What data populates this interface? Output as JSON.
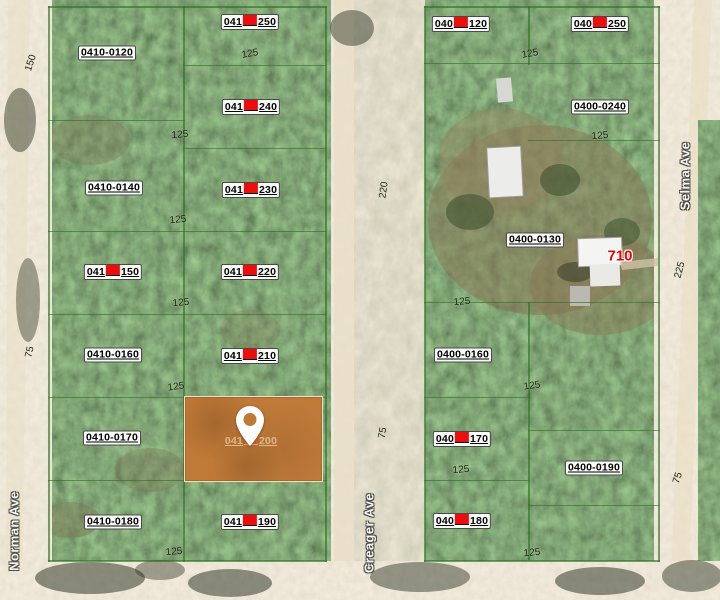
{
  "map": {
    "streets": [
      {
        "name": "Norman Ave",
        "x": 14,
        "y": 531
      },
      {
        "name": "Creager Ave",
        "x": 369,
        "y": 533
      },
      {
        "name": "Selma Ave",
        "x": 685,
        "y": 176
      }
    ],
    "house_number": {
      "text": "710",
      "x": 620,
      "y": 256
    },
    "highlighted_parcel": {
      "x": 184,
      "y": 396,
      "w": 137,
      "h": 84,
      "fill": "#bf7a38"
    },
    "parcel_labels": [
      {
        "text": "0410-0120",
        "x": 107,
        "y": 53
      },
      {
        "prefix": "041",
        "suffix": "250",
        "redacted": true,
        "x": 250,
        "y": 22
      },
      {
        "prefix": "041",
        "suffix": "240",
        "redacted": true,
        "x": 251,
        "y": 107
      },
      {
        "text": "0410-0140",
        "x": 114,
        "y": 188
      },
      {
        "prefix": "041",
        "suffix": "230",
        "redacted": true,
        "x": 251,
        "y": 190
      },
      {
        "prefix": "041",
        "suffix": "150",
        "redacted": true,
        "x": 113,
        "y": 272
      },
      {
        "prefix": "041",
        "suffix": "220",
        "redacted": true,
        "x": 250,
        "y": 272
      },
      {
        "text": "0410-0160",
        "x": 113,
        "y": 355
      },
      {
        "prefix": "041",
        "suffix": "210",
        "redacted": true,
        "x": 250,
        "y": 356
      },
      {
        "text": "0410-0170",
        "x": 112,
        "y": 438
      },
      {
        "prefix": "041",
        "suffix": "200",
        "redacted": true,
        "faint": true,
        "x": 251,
        "y": 441
      },
      {
        "text": "0410-0180",
        "x": 113,
        "y": 522
      },
      {
        "prefix": "041",
        "suffix": "190",
        "redacted": true,
        "x": 250,
        "y": 522
      },
      {
        "prefix": "040",
        "suffix": "120",
        "redacted": true,
        "x": 461,
        "y": 24
      },
      {
        "prefix": "040",
        "suffix": "250",
        "redacted": true,
        "x": 600,
        "y": 24
      },
      {
        "text": "0400-0240",
        "x": 600,
        "y": 107
      },
      {
        "text": "0400-0130",
        "x": 535,
        "y": 240
      },
      {
        "text": "0400-0160",
        "x": 463,
        "y": 355
      },
      {
        "prefix": "040",
        "suffix": "170",
        "redacted": true,
        "x": 462,
        "y": 439
      },
      {
        "text": "0400-0190",
        "x": 594,
        "y": 468
      },
      {
        "prefix": "040",
        "suffix": "180",
        "redacted": true,
        "x": 462,
        "y": 521
      }
    ],
    "dimension_labels": [
      {
        "text": "150",
        "x": 31,
        "y": 63,
        "rot": -72
      },
      {
        "text": "125",
        "x": 250,
        "y": 54,
        "rot": -10
      },
      {
        "text": "125",
        "x": 180,
        "y": 135,
        "rot": -5
      },
      {
        "text": "125",
        "x": 178,
        "y": 220,
        "rot": -5
      },
      {
        "text": "125",
        "x": 181,
        "y": 303,
        "rot": -5
      },
      {
        "text": "125",
        "x": 176,
        "y": 387,
        "rot": -8
      },
      {
        "text": "125",
        "x": 174,
        "y": 552,
        "rot": -5
      },
      {
        "text": "75",
        "x": 30,
        "y": 352,
        "rot": -78
      },
      {
        "text": "125",
        "x": 530,
        "y": 54,
        "rot": -10
      },
      {
        "text": "125",
        "x": 600,
        "y": 136,
        "rot": -5
      },
      {
        "text": "125",
        "x": 462,
        "y": 302,
        "rot": -5
      },
      {
        "text": "125",
        "x": 532,
        "y": 386,
        "rot": -8
      },
      {
        "text": "125",
        "x": 461,
        "y": 470,
        "rot": -5
      },
      {
        "text": "125",
        "x": 532,
        "y": 553,
        "rot": -5
      },
      {
        "text": "220",
        "x": 384,
        "y": 190,
        "rot": -82
      },
      {
        "text": "225",
        "x": 680,
        "y": 270,
        "rot": -75
      },
      {
        "text": "75",
        "x": 383,
        "y": 433,
        "rot": -80
      },
      {
        "text": "75",
        "x": 678,
        "y": 478,
        "rot": -72
      }
    ],
    "parcel_lines": [
      {
        "x": 48,
        "y": 6,
        "w": 279,
        "h": 2
      },
      {
        "x": 48,
        "y": 6,
        "w": 2,
        "h": 556
      },
      {
        "x": 325,
        "y": 6,
        "w": 2,
        "h": 556
      },
      {
        "x": 48,
        "y": 560,
        "w": 279,
        "h": 2
      },
      {
        "x": 183,
        "y": 6,
        "w": 2,
        "h": 556
      },
      {
        "x": 183,
        "y": 65,
        "w": 144,
        "h": 1
      },
      {
        "x": 183,
        "y": 148,
        "w": 144,
        "h": 1
      },
      {
        "x": 48,
        "y": 120,
        "w": 137,
        "h": 1
      },
      {
        "x": 48,
        "y": 231,
        "w": 279,
        "h": 1
      },
      {
        "x": 48,
        "y": 314,
        "w": 279,
        "h": 1
      },
      {
        "x": 48,
        "y": 397,
        "w": 279,
        "h": 1
      },
      {
        "x": 48,
        "y": 480,
        "w": 279,
        "h": 1
      },
      {
        "x": 424,
        "y": 6,
        "w": 236,
        "h": 2
      },
      {
        "x": 424,
        "y": 6,
        "w": 2,
        "h": 556
      },
      {
        "x": 658,
        "y": 6,
        "w": 2,
        "h": 556
      },
      {
        "x": 424,
        "y": 560,
        "w": 236,
        "h": 2
      },
      {
        "x": 424,
        "y": 63,
        "w": 236,
        "h": 1
      },
      {
        "x": 424,
        "y": 302,
        "w": 236,
        "h": 1
      },
      {
        "x": 528,
        "y": 140,
        "w": 132,
        "h": 1
      },
      {
        "x": 528,
        "y": 430,
        "w": 132,
        "h": 1
      },
      {
        "x": 528,
        "y": 505,
        "w": 132,
        "h": 1
      },
      {
        "x": 424,
        "y": 397,
        "w": 106,
        "h": 1
      },
      {
        "x": 424,
        "y": 480,
        "w": 106,
        "h": 1
      },
      {
        "x": 528,
        "y": 6,
        "w": 2,
        "h": 59
      },
      {
        "x": 528,
        "y": 302,
        "w": 2,
        "h": 258
      }
    ],
    "colors": {
      "boundary_green": "#2c7426",
      "redaction_red": "#ee0d0d",
      "highlight_orange": "#bf7a38",
      "house_number_red": "#e60000",
      "road_sand": "#d9c9ab"
    }
  }
}
